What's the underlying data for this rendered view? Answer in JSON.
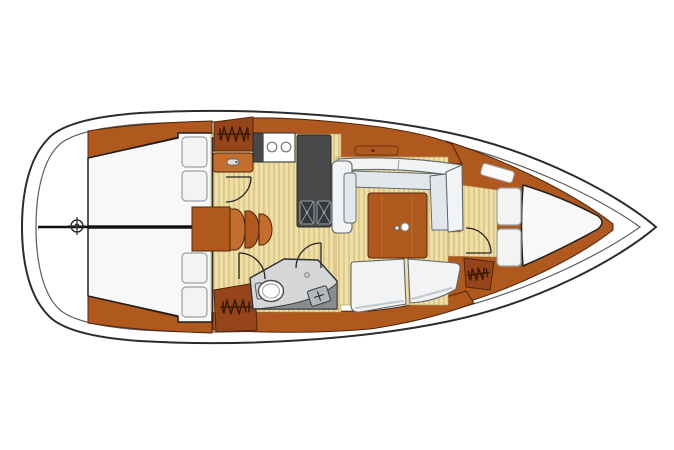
{
  "diagram": {
    "type": "sailboat-interior-floor-plan",
    "orientation": {
      "bow": "right",
      "stern": "left"
    },
    "features": [
      "aft-double-cabin-upper",
      "aft-double-cabin-lower",
      "transom-center-mark",
      "companionway-steps",
      "galley-with-stove-and-double-sink",
      "hanging-locker-galley",
      "hanging-locker-aft",
      "hanging-locker-forward",
      "wet-head-with-toilet-and-sink",
      "u-shaped-salon-settee-with-table",
      "aft-facing-salon-bench",
      "v-berth-forward-cabin",
      "door-swings"
    ],
    "counts": {
      "stove_burners": 2,
      "galley_sinks": 2,
      "aft_berth_pillows": 4,
      "v_berth_pillows": 2,
      "hanging_lockers": 3,
      "door_swings": 4,
      "table_fitting_dots": 2
    },
    "icons": {
      "hanging_locker": "zigzag-hanger-symbol",
      "center_mark": "crosshair-circle",
      "sink": "square-with-diagonal-cross",
      "stove": "two-burner-rings"
    }
  },
  "palette": {
    "hull_line": "#2c2c2c",
    "hull_line_light": "#5b5b5b",
    "deck": "#ffffff",
    "wood": "#b0591f",
    "wood_light": "#c36d2f",
    "wood_dark": "#96451a",
    "wood_edge": "#50250a",
    "floor": "#eedfa6",
    "floor_stripe": "#dcc687",
    "counter": "#47494b",
    "sink": "#35383a",
    "sink_mark": "#9a9da0",
    "berth": "#f8f8f8",
    "berth_edge": "#1f1f1f",
    "pillow": "#f3f3f3",
    "pillow_edge": "#9aa0a4",
    "settee_back": "#f1f3f5",
    "settee_seat": "#e2e7eb",
    "settee_edge": "#5f666c",
    "head_floor": "#d4d6d8",
    "head_counter": "#8a8d90",
    "toilet": "#ffffff",
    "door": "#262626",
    "glyph": "#3a1a05",
    "structure": "#101010"
  }
}
